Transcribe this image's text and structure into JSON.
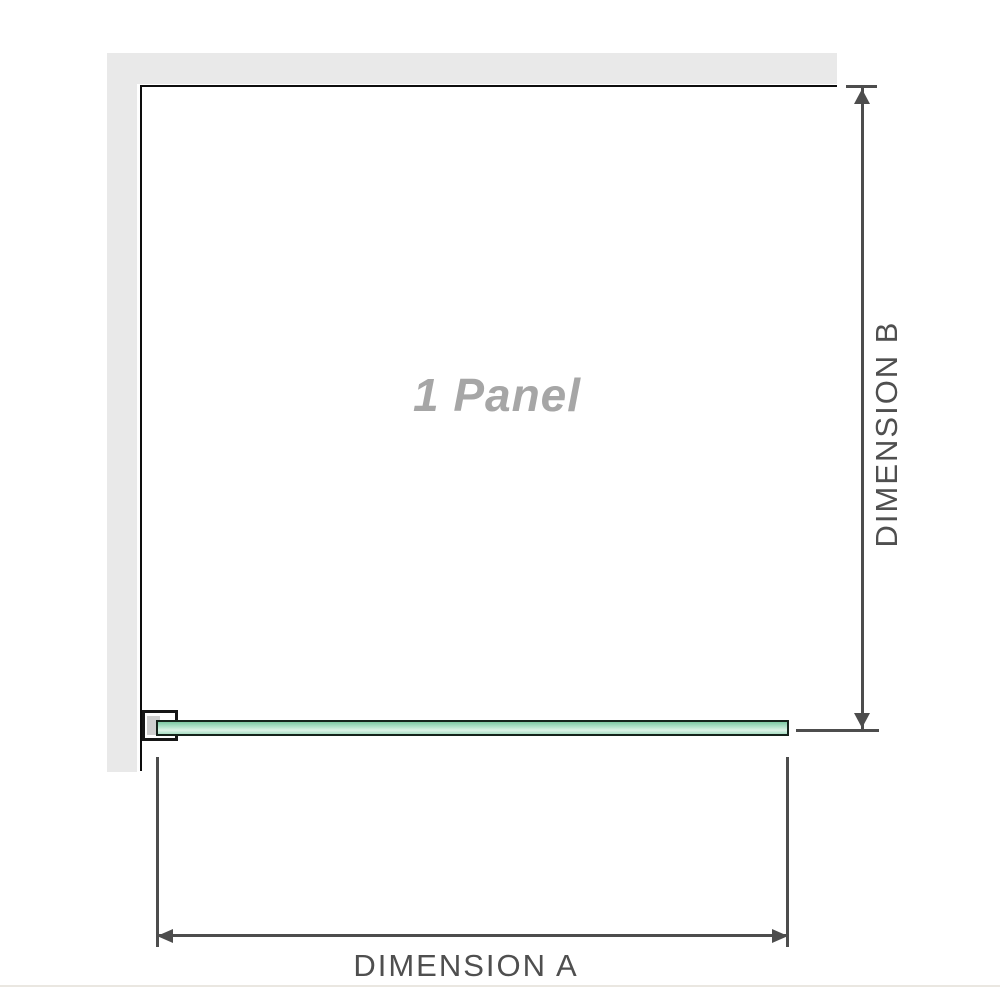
{
  "diagram": {
    "title": "Shower panel dimension diagram",
    "panel_label": "1 Panel",
    "dimension_a": {
      "label": "DIMENSION A",
      "orientation": "horizontal"
    },
    "dimension_b": {
      "label": "DIMENSION B",
      "orientation": "vertical"
    },
    "elements": {
      "wall": "L-shaped wall (top and left)",
      "glass_panel": "green glass bar with wall bracket at left end",
      "bracket": "wall-mount clamp"
    }
  },
  "colors": {
    "background": "#ffffff",
    "wall_gray": "#e9e9e9",
    "panel_border": "#0d0d0d",
    "dimension_line": "#4d4d4d",
    "dimension_text": "#4f4f4f",
    "panel_label_text": "#a6a6a6",
    "glass_green_dark": "#7ec9a3",
    "glass_green_light": "#ddf2e6",
    "glass_border": "#15231b",
    "bracket_border": "#161616",
    "bracket_pad": "#cfcfcf",
    "bottom_rule": "#eae7e1"
  }
}
